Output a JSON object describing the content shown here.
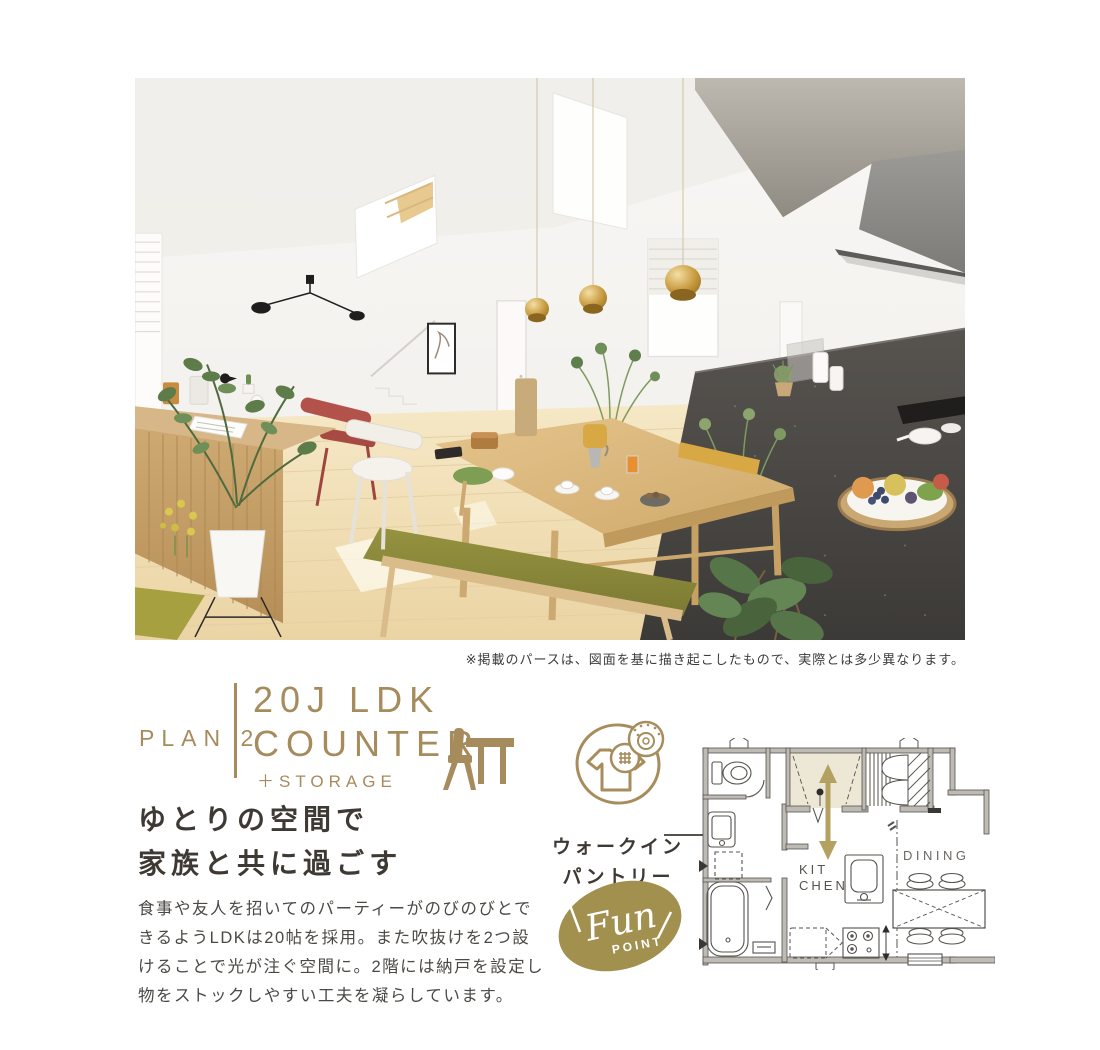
{
  "colors": {
    "accent_gold": "#A68B5C",
    "badge_olive": "#A2904F",
    "arrow_gold": "#B4A161",
    "pantry_highlight": "#EDE7D6",
    "heading_text": "#3E3933",
    "body_text": "#4C4945"
  },
  "disclaimer": "※掲載のパースは、図面を基に描き起こしたもので、実際とは多少異なります。",
  "plan_header": {
    "plan_label": "PLAN 2",
    "title_line1": "20J LDK",
    "title_line2": "COUNTER",
    "subtitle": "＋STORAGE"
  },
  "headline": {
    "line1": "ゆとりの空間で",
    "line2": "家族と共に過ごす"
  },
  "body": {
    "lines": [
      "食事や友人を招いてのパーティーがのびのびとで",
      "きるようLDKは20帖を採用。また吹抜けを2つ設",
      "けることで光が注ぐ空間に。2階には納戸を設定し",
      "物をストックしやすい工夫を凝らしています。"
    ]
  },
  "pantry_callout": {
    "line1": "ウォークイン",
    "line2": "パントリー"
  },
  "fun_badge": {
    "script_text": "Fun",
    "caption": "POINT"
  },
  "floor_plan": {
    "kitchen_line1": "KIT",
    "kitchen_line2": "CHEN",
    "dining_label": "DINING"
  }
}
